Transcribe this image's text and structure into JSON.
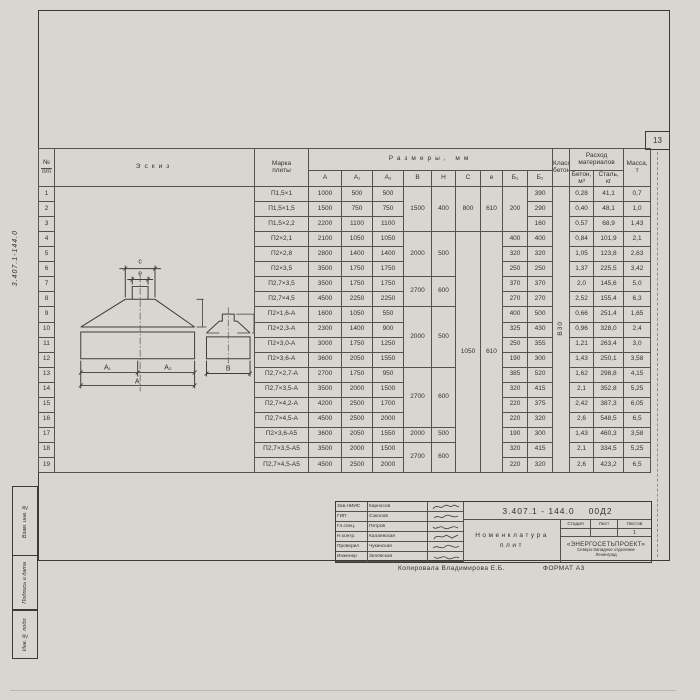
{
  "sheet": {
    "page_number": "13"
  },
  "margin": {
    "doc_number_vertical": "3.407.1-144.0",
    "stamp1": "Взам. инв. №",
    "stamp2": "Подпись и дата",
    "stamp3": "Инв. № подл."
  },
  "table": {
    "headers": {
      "num_line1": "№",
      "num_line2": "п/п",
      "eskiz": "Эскиз",
      "marka_line1": "Марка",
      "marka_line2": "плиты",
      "razmery": "Размеры,  мм",
      "dims": [
        "A",
        "A₁",
        "A₂",
        "B",
        "H",
        "C",
        "e",
        "Б₁",
        "Б₂"
      ],
      "klass_line1": "Класс",
      "klass_line2": "бетона",
      "rashod_line1": "Расход",
      "rashod_line2": "материалов",
      "beton_line1": "Бетон,",
      "beton_line2": "м³",
      "stal_line1": "Сталь,",
      "stal_line2": "кг",
      "massa_line1": "Масса,",
      "massa_line2": "т"
    },
    "rows": [
      {
        "n": "1",
        "marka": "П1,5×1",
        "a": "1000",
        "a1": "500",
        "a2": "500",
        "b": {
          "v": "1500",
          "rs": 3
        },
        "h": {
          "v": "400",
          "rs": 3
        },
        "c": {
          "v": "800",
          "rs": 3
        },
        "e": {
          "v": "610",
          "rs": 3
        },
        "b1": {
          "v": "200",
          "rs": 3
        },
        "b2": "390",
        "klass": {
          "v": "В30",
          "rs": 19,
          "rot": true
        },
        "beton": "0,28",
        "stal": "41,1",
        "massa": "0,7"
      },
      {
        "n": "2",
        "marka": "П1,5×1,5",
        "a": "1500",
        "a1": "750",
        "a2": "750",
        "b2": "290",
        "beton": "0,40",
        "stal": "48,1",
        "massa": "1,0"
      },
      {
        "n": "3",
        "marka": "П1,5×2,2",
        "a": "2200",
        "a1": "1100",
        "a2": "1100",
        "b2": "160",
        "beton": "0,57",
        "stal": "68,9",
        "massa": "1,43"
      },
      {
        "n": "4",
        "marka": "П2×2,1",
        "a": "2100",
        "a1": "1050",
        "a2": "1050",
        "b": {
          "v": "2000",
          "rs": 3
        },
        "h": {
          "v": "500",
          "rs": 3
        },
        "c": {
          "v": "1050",
          "rs": 16
        },
        "e": {
          "v": "610",
          "rs": 16
        },
        "b1": "400",
        "b2": "400",
        "beton": "0,84",
        "stal": "101,9",
        "massa": "2,1"
      },
      {
        "n": "5",
        "marka": "П2×2,8",
        "a": "2800",
        "a1": "1400",
        "a2": "1400",
        "b1": "320",
        "b2": "320",
        "beton": "1,05",
        "stal": "123,8",
        "massa": "2,63"
      },
      {
        "n": "6",
        "marka": "П2×3,5",
        "a": "3500",
        "a1": "1750",
        "a2": "1750",
        "b1": "250",
        "b2": "250",
        "beton": "1,37",
        "stal": "225,5",
        "massa": "3,42"
      },
      {
        "n": "7",
        "marka": "П2,7×3,5",
        "a": "3500",
        "a1": "1750",
        "a2": "1750",
        "b": {
          "v": "2700",
          "rs": 2
        },
        "h": {
          "v": "600",
          "rs": 2
        },
        "b1": "370",
        "b2": "370",
        "beton": "2,0",
        "stal": "145,6",
        "massa": "5,0"
      },
      {
        "n": "8",
        "marka": "П2,7×4,5",
        "a": "4500",
        "a1": "2250",
        "a2": "2250",
        "b1": "270",
        "b2": "270",
        "beton": "2,52",
        "stal": "155,4",
        "massa": "6,3"
      },
      {
        "n": "9",
        "marka": "П2×1,6-А",
        "a": "1600",
        "a1": "1050",
        "a2": "550",
        "b": {
          "v": "2000",
          "rs": 4
        },
        "h": {
          "v": "500",
          "rs": 4
        },
        "b1": "400",
        "b2": "500",
        "beton": "0,66",
        "stal": "251,4",
        "massa": "1,65"
      },
      {
        "n": "10",
        "marka": "П2×2,3-А",
        "a": "2300",
        "a1": "1400",
        "a2": "900",
        "b1": "325",
        "b2": "430",
        "beton": "0,96",
        "stal": "328,0",
        "massa": "2,4"
      },
      {
        "n": "11",
        "marka": "П2×3,0-А",
        "a": "3000",
        "a1": "1750",
        "a2": "1250",
        "b1": "250",
        "b2": "355",
        "beton": "1,21",
        "stal": "263,4",
        "massa": "3,0"
      },
      {
        "n": "12",
        "marka": "П2×3,6-А",
        "a": "3600",
        "a1": "2050",
        "a2": "1550",
        "b1": "190",
        "b2": "300",
        "beton": "1,43",
        "stal": "250,1",
        "massa": "3,58"
      },
      {
        "n": "13",
        "marka": "П2,7×2,7-А",
        "a": "2700",
        "a1": "1750",
        "a2": "950",
        "b": {
          "v": "2700",
          "rs": 4
        },
        "h": {
          "v": "600",
          "rs": 4
        },
        "b1": "385",
        "b2": "520",
        "beton": "1,62",
        "stal": "298,8",
        "massa": "4,15"
      },
      {
        "n": "14",
        "marka": "П2,7×3,5-А",
        "a": "3500",
        "a1": "2000",
        "a2": "1500",
        "b1": "320",
        "b2": "415",
        "beton": "2,1",
        "stal": "352,8",
        "massa": "5,25"
      },
      {
        "n": "15",
        "marka": "П2,7×4,2-А",
        "a": "4200",
        "a1": "2500",
        "a2": "1700",
        "b1": "220",
        "b2": "375",
        "beton": "2,42",
        "stal": "387,3",
        "massa": "6,05"
      },
      {
        "n": "16",
        "marka": "П2,7×4,5-А",
        "a": "4500",
        "a1": "2500",
        "a2": "2000",
        "b1": "220",
        "b2": "320",
        "beton": "2,6",
        "stal": "548,5",
        "massa": "6,5"
      },
      {
        "n": "17",
        "marka": "П2×3,6-А5",
        "a": "3600",
        "a1": "2050",
        "a2": "1550",
        "b": "2000",
        "h": "500",
        "b1": "190",
        "b2": "300",
        "beton": "1,43",
        "stal": "460,3",
        "massa": "3,58"
      },
      {
        "n": "18",
        "marka": "П2,7×3,5-А5",
        "a": "3500",
        "a1": "2000",
        "a2": "1500",
        "b": {
          "v": "2700",
          "rs": 2
        },
        "h": {
          "v": "600",
          "rs": 2
        },
        "b1": "320",
        "b2": "415",
        "beton": "2,1",
        "stal": "334,5",
        "massa": "5,25"
      },
      {
        "n": "19",
        "marka": "П2,7×4,5-А5",
        "a": "4500",
        "a1": "2500",
        "a2": "2000",
        "b1": "220",
        "b2": "320",
        "beton": "2,6",
        "stal": "423,2",
        "massa": "6,5"
      }
    ]
  },
  "sketch": {
    "c": "c",
    "e": "e",
    "a1": "A₁",
    "a2": "A₂",
    "a": "A",
    "b": "B",
    "dim100": "100"
  },
  "titleblock": {
    "doc_number": "3.407.1 - 144.0",
    "doc_suffix": "00Д2",
    "title_line1": "Номенклатура",
    "title_line2": "плит",
    "stage_label": "Стадия",
    "sheet_label": "Лист",
    "sheets_label": "Листов",
    "sheets_value": "1",
    "org_name": "«ЭНЕРГОСЕТЬПРОЕКТ»",
    "org_line2": "Северо-Западное отделение",
    "org_line3": "Ленинград",
    "people": [
      {
        "role": "Зав.НИИС",
        "name": "Карносов"
      },
      {
        "role": "ГИП",
        "name": "Соколов"
      },
      {
        "role": "Гл.спец.",
        "name": "Петров"
      },
      {
        "role": "Н.контр.",
        "name": "Калаевская"
      },
      {
        "role": "Проверил",
        "name": "Чукинская"
      },
      {
        "role": "Инженер",
        "name": "Зелевская"
      }
    ]
  },
  "footer": {
    "copy": "Копировала Владимирова Е.Б.",
    "format": "ФОРМАТ А3"
  }
}
